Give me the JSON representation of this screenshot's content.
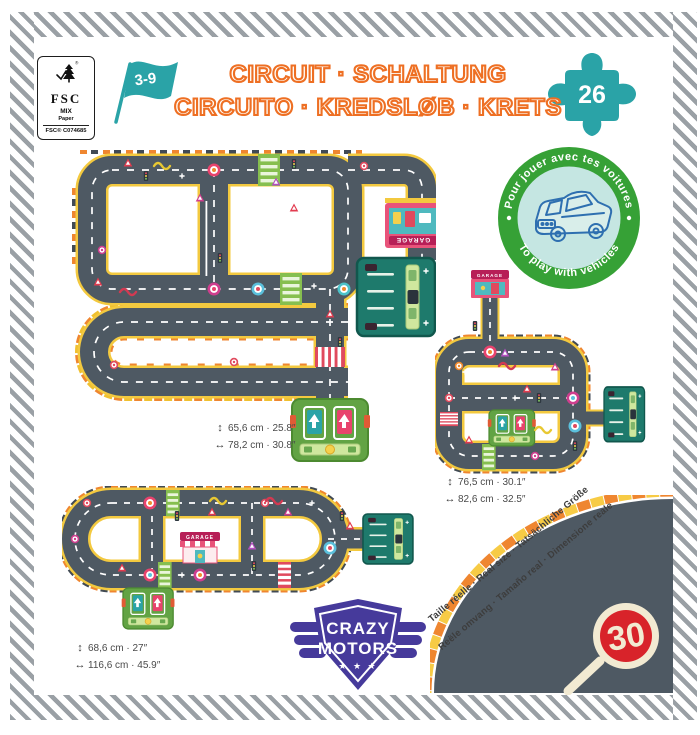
{
  "certification": {
    "fsc_label": "FSC",
    "mix": "MIX",
    "paper": "Paper",
    "code": "FSC® C074685"
  },
  "age_flag": {
    "label": "3-9"
  },
  "title": {
    "line1": "CIRCUIT · SCHALTUNG",
    "line2": "CIRCUITO · KREDSLØB · KRETS"
  },
  "pieces_badge": {
    "count": "26"
  },
  "play_badge": {
    "top": "Pour jouer avec tes voitures",
    "bottom": "To play with vehicles"
  },
  "circuits": [
    {
      "name": "circuit-medium",
      "garage_sign": "GARAGE",
      "height_label": "65,6 cm · 25.8″",
      "width_label": "78,2 cm · 30.8″"
    },
    {
      "name": "circuit-small",
      "garage_sign": "GARAGE",
      "height_label": "76,5 cm · 30.1″",
      "width_label": "82,6 cm · 32.5″"
    },
    {
      "name": "circuit-large",
      "garage_sign": "GARAGE",
      "height_label": "68,6 cm · 27″",
      "width_label": "116,6 cm · 45.9″"
    }
  ],
  "real_size_note": {
    "line1": "Taille réelle · Real size · Tatsächliche Größe",
    "line2": "Reële omvang · Tamaño real · Dimensione reale"
  },
  "speed_sign": {
    "value": "30"
  },
  "brand": {
    "line1": "CRAZY",
    "line2": "MOTORS",
    "stars": "★ ★ ★"
  },
  "icons": {
    "height_arrow": "↕",
    "width_arrow": "↔"
  },
  "colors": {
    "accent_orange": "#ee6f23",
    "teal": "#2aa3a7",
    "badge_green": "#36a136",
    "road": "#4e5963",
    "road_edge": "#f3c93f",
    "brand_purple": "#463a9b",
    "sign_red": "#d8232a"
  }
}
